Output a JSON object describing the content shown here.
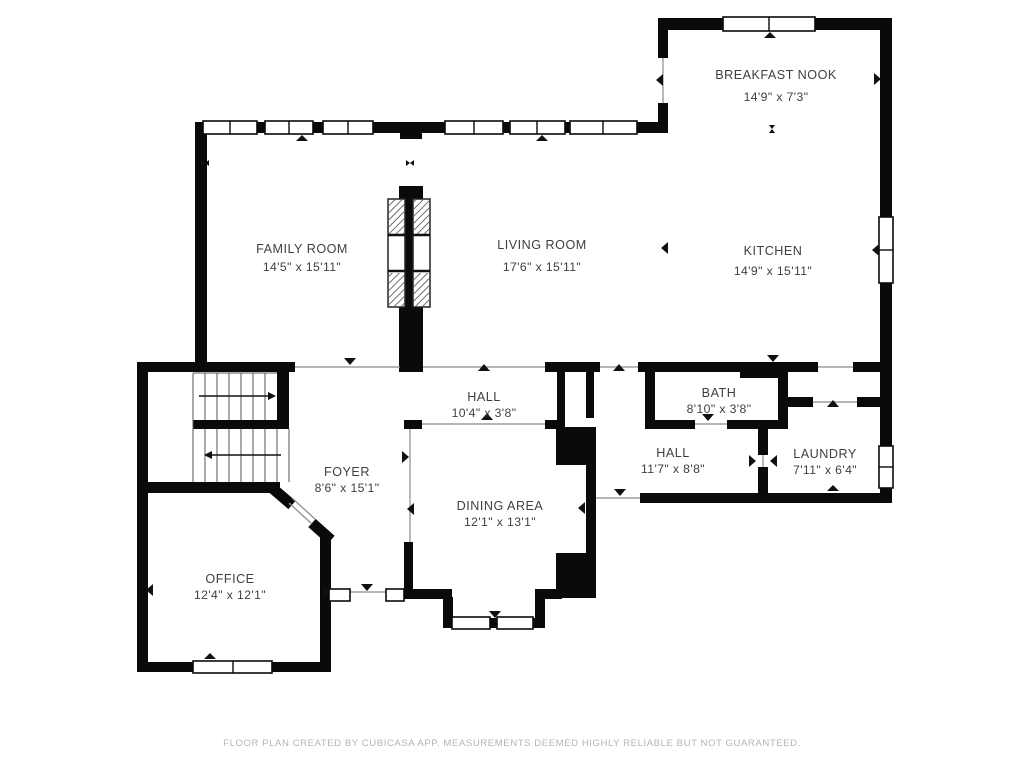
{
  "rooms": [
    {
      "name": "BREAKFAST NOOK",
      "dims": "14'9\" x 7'3\""
    },
    {
      "name": "FAMILY ROOM",
      "dims": "14'5\" x 15'11\""
    },
    {
      "name": "LIVING ROOM",
      "dims": "17'6\" x 15'11\""
    },
    {
      "name": "KITCHEN",
      "dims": "14'9\" x 15'11\""
    },
    {
      "name": "HALL",
      "dims": "10'4\" x 3'8\""
    },
    {
      "name": "BATH",
      "dims": "8'10\" x 3'8\""
    },
    {
      "name": "FOYER",
      "dims": "8'6\" x 15'1\""
    },
    {
      "name": "HALL",
      "dims": "11'7\" x 8'8\""
    },
    {
      "name": "LAUNDRY",
      "dims": "7'11\" x 6'4\""
    },
    {
      "name": "DINING AREA",
      "dims": "12'1\" x 13'1\""
    },
    {
      "name": "OFFICE",
      "dims": "12'4\" x 12'1\""
    }
  ],
  "footer": "FLOOR PLAN CREATED BY CUBICASA APP. MEASUREMENTS DEEMED HIGHLY RELIABLE BUT NOT GUARANTEED.",
  "colors": {
    "wall": "#0a0a0a",
    "label": "#3f3f3f",
    "footer": "#b4b4b4",
    "background": "#ffffff"
  }
}
